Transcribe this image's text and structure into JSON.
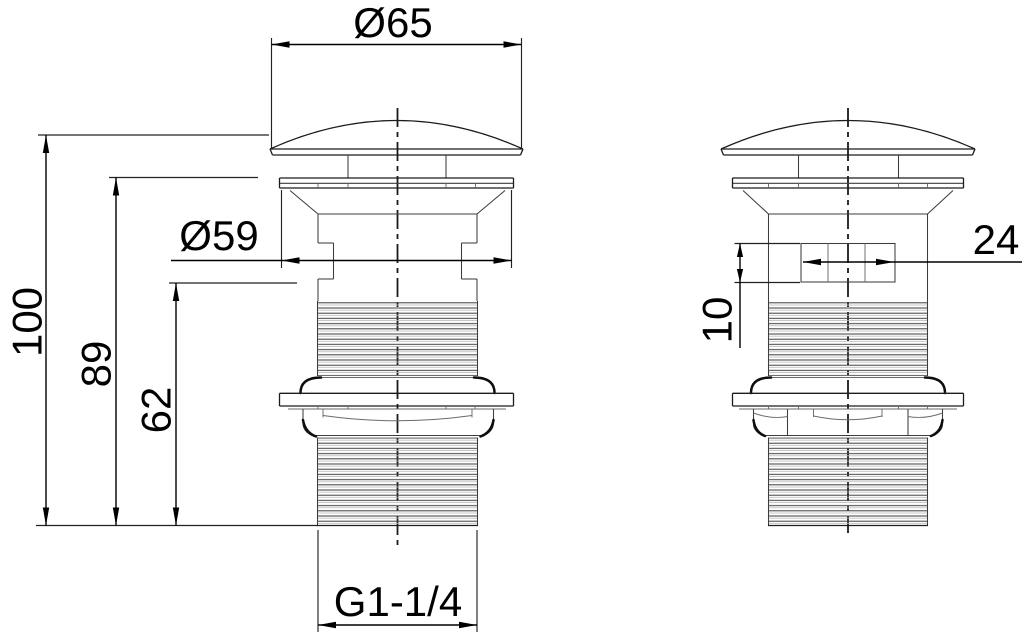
{
  "drawing": {
    "type": "technical-dimension-drawing",
    "subject": "basin pop-up waste fitting, two orthographic views",
    "background_color": "#ffffff",
    "line_color": "#1c1c1c",
    "views": [
      {
        "name": "front-view-with-overflow-recess"
      },
      {
        "name": "side-view-with-overflow-slot"
      }
    ],
    "dimensions": {
      "cap_diameter": "Ø65",
      "flange_diameter": "Ø59",
      "overall_height": "100",
      "height_to_flange": "89",
      "height_to_overflow": "62",
      "thread_size": "G1-1/4",
      "overflow_slot_width": "24",
      "overflow_slot_height": "10"
    }
  }
}
